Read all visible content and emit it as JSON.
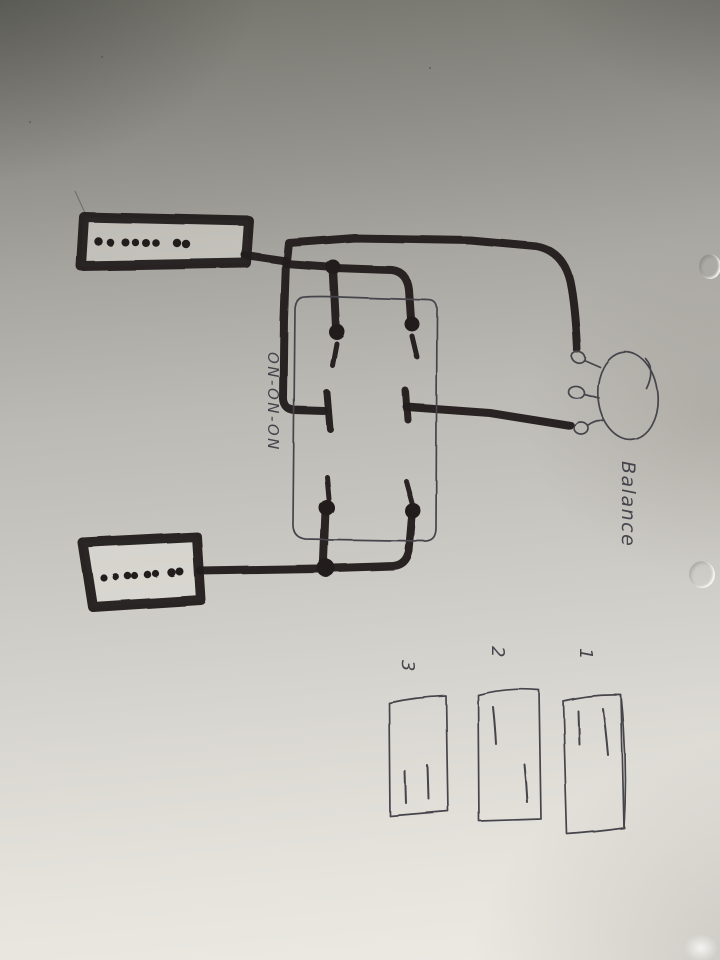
{
  "labels": {
    "switch_type": "ON-ON-ON",
    "pot": "Balance"
  },
  "positions": {
    "p1": "1",
    "p2": "2",
    "p3": "3"
  },
  "colors": {
    "marker": "#221f1c",
    "pen": "#45444c",
    "paper_top": "#73736c",
    "paper_bottom": "#eceae3"
  }
}
